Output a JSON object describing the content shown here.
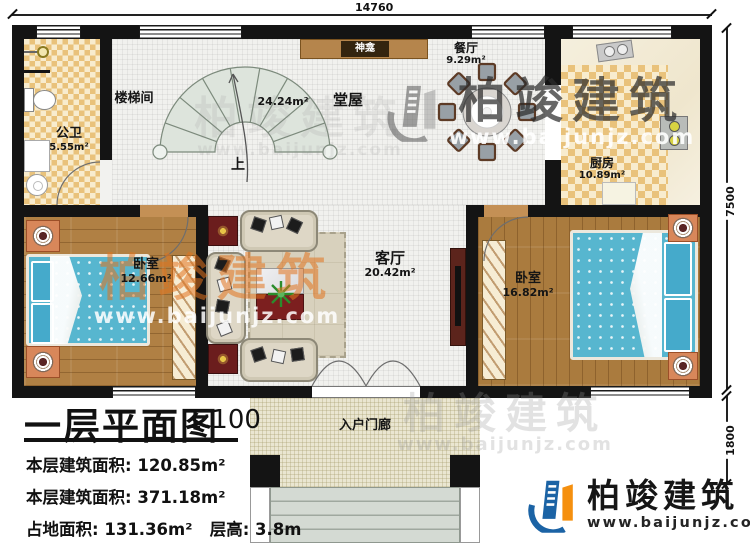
{
  "plan": {
    "dimensions": {
      "width_mm": "14760",
      "depth_mm": "7500",
      "porch_depth_mm": "1800"
    },
    "rooms": {
      "bathroom": {
        "name": "公卫",
        "area": "5.55m²"
      },
      "stairwell": {
        "name": "楼梯间"
      },
      "stairs_direction": "上",
      "hall": {
        "name": "堂屋",
        "area": "24.24m²"
      },
      "shrine": {
        "name": "神龛"
      },
      "dining": {
        "name": "餐厅",
        "area": "9.29m²"
      },
      "kitchen": {
        "name": "厨房",
        "area": "10.89m²"
      },
      "bedroom_left": {
        "name": "卧室",
        "area": "12.66m²"
      },
      "living": {
        "name": "客厅",
        "area": "20.42m²"
      },
      "bedroom_right": {
        "name": "卧室",
        "area": "16.82m²"
      },
      "porch": {
        "name": "入户门廊"
      }
    }
  },
  "title_block": {
    "title": "一层平面图",
    "scale": "1:100",
    "rows": [
      {
        "label": "本层建筑面积:",
        "value": "120.85m²"
      },
      {
        "label": "本层建筑面积:",
        "value": "371.18m²"
      },
      {
        "label": "占地面积:",
        "value": "131.36m²"
      },
      {
        "label": "层高:",
        "value": "3.8m"
      }
    ]
  },
  "brand": {
    "name": "柏竣建筑",
    "url": "www.baijunjz.com"
  },
  "colors": {
    "wall": "#141414",
    "checker_tile": "#e9c27b",
    "wood_floor": "#b08044",
    "bed": "#57b6cf",
    "brand_blue": "#1b63a5",
    "brand_orange": "#f5900f"
  }
}
